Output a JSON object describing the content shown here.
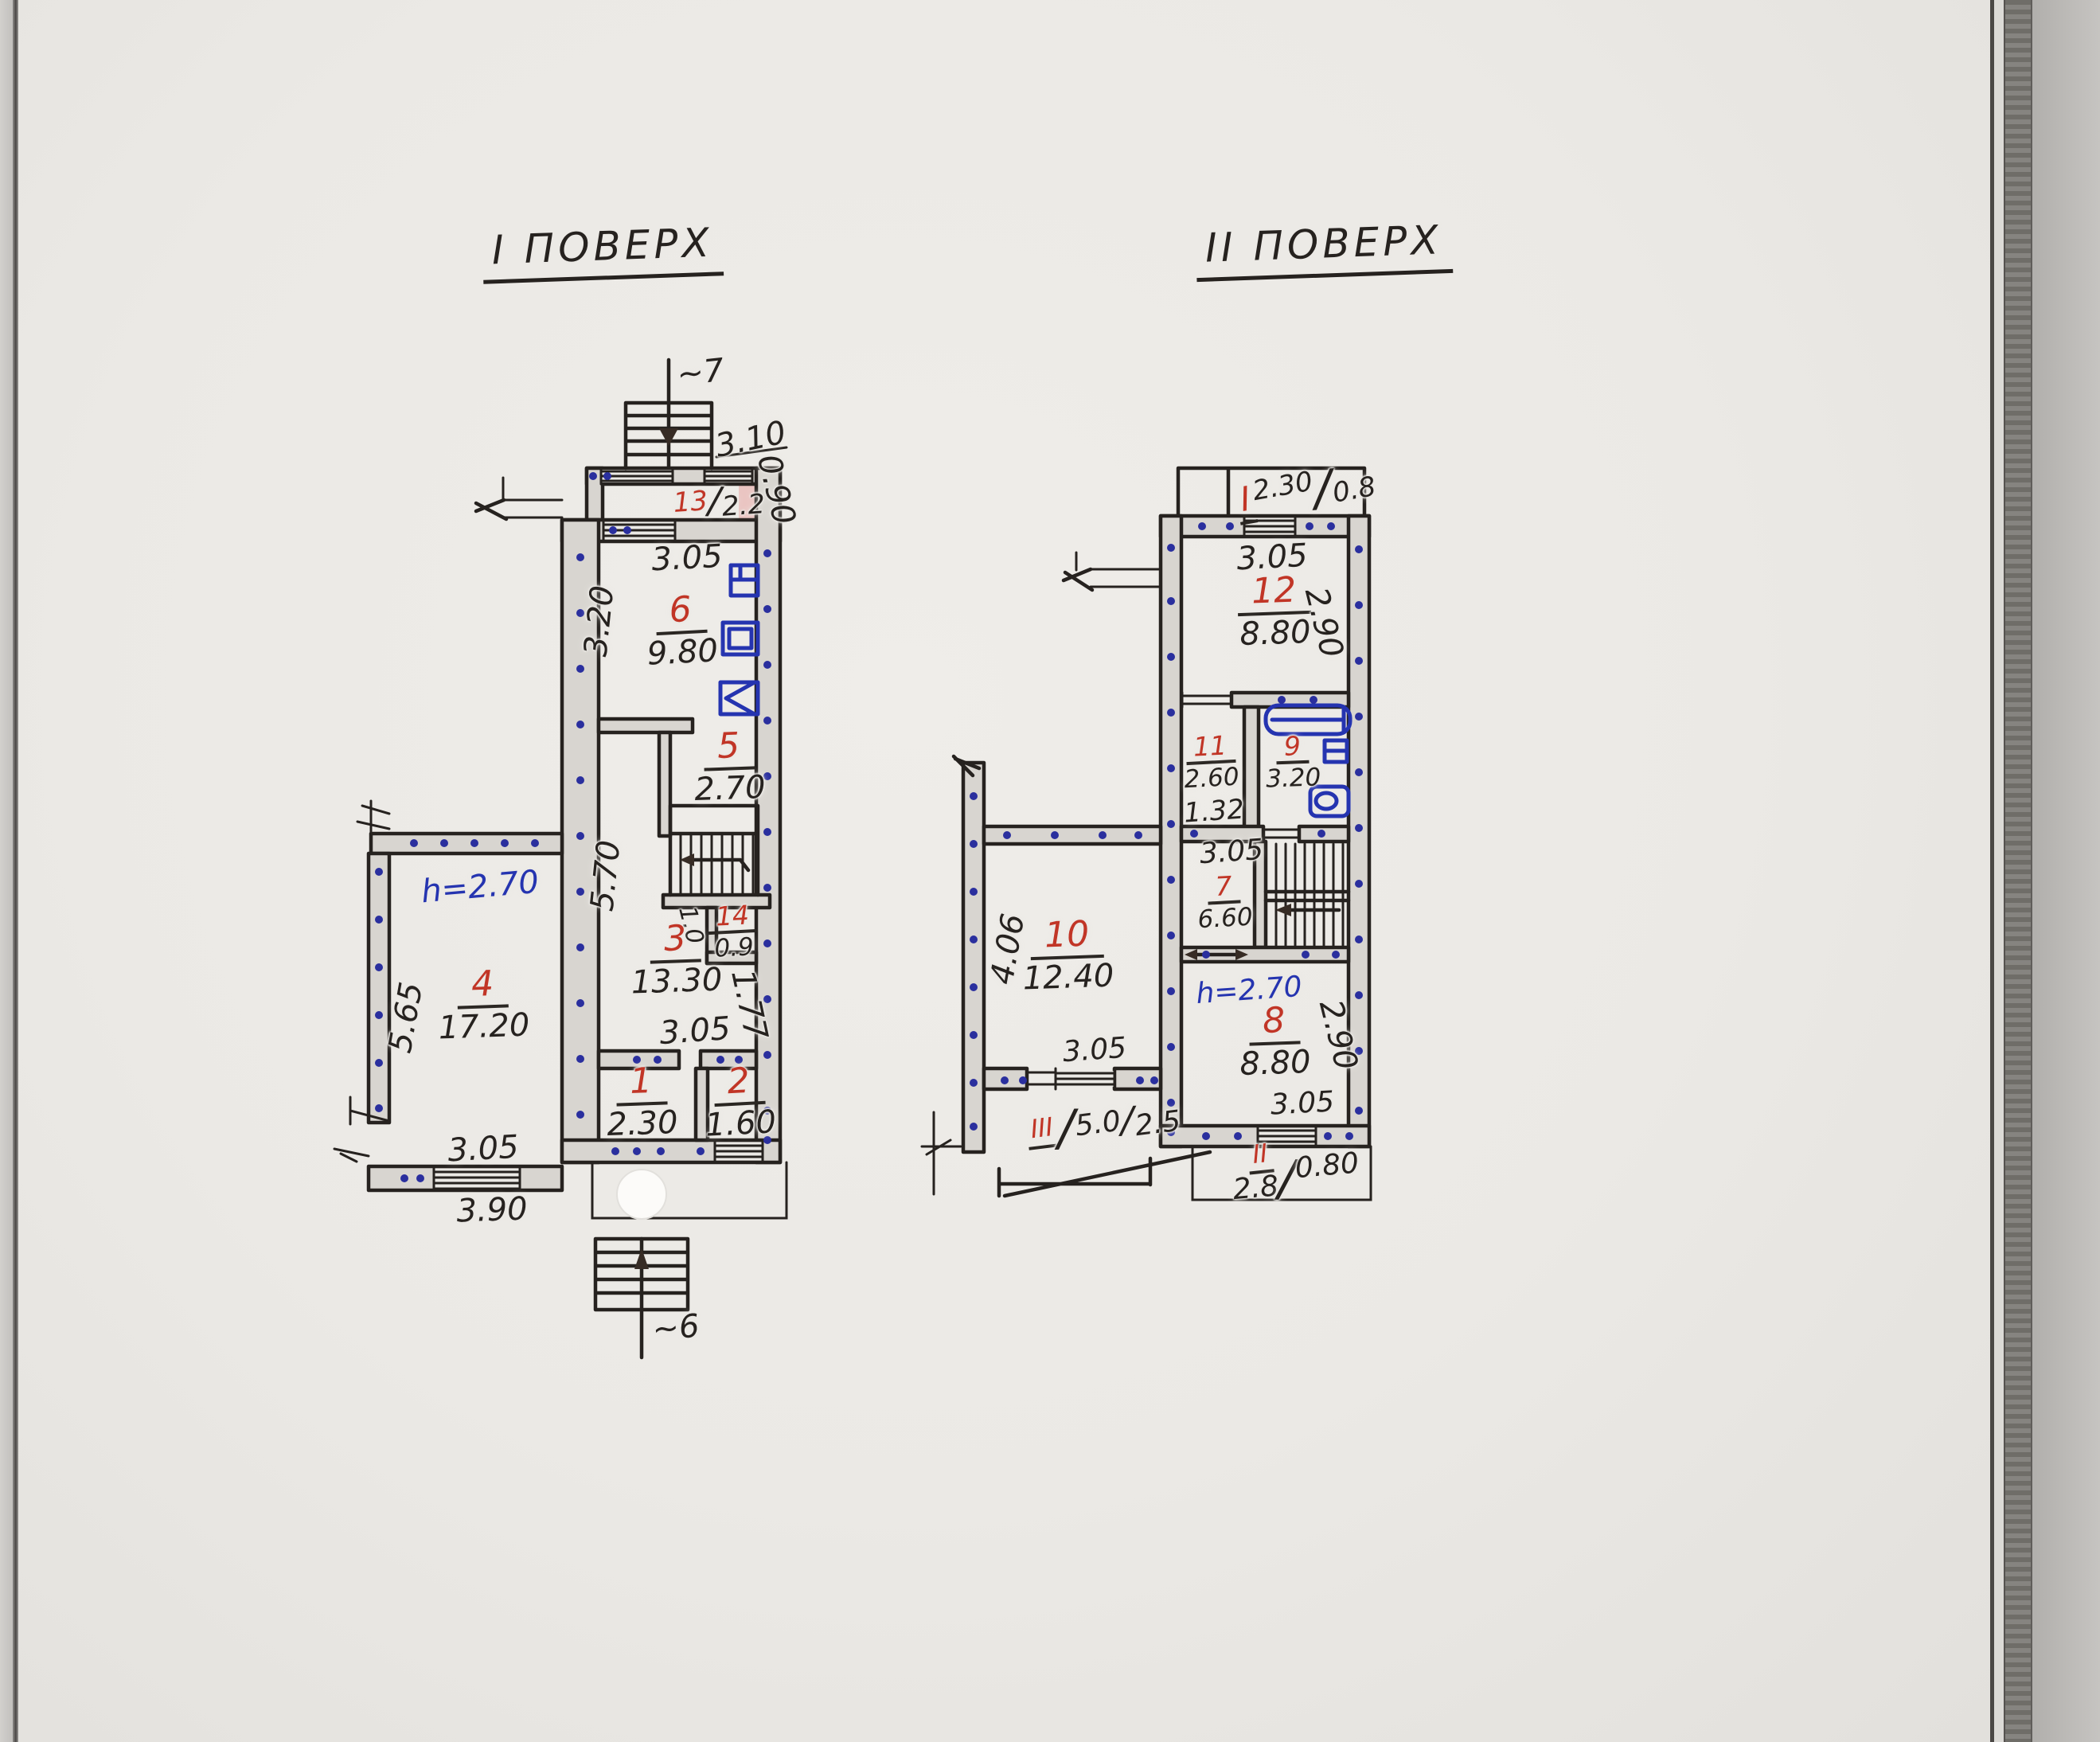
{
  "notation": {
    "slash": "/"
  },
  "floor1": {
    "title": "I ПОВЕРХ",
    "stairs_up": "~7",
    "stairs_down": "~6",
    "height_note": "h=2.70",
    "rooms": {
      "r1": {
        "num": "1",
        "area": "2.30"
      },
      "r2": {
        "num": "2",
        "area": "1.60"
      },
      "r3": {
        "num": "3",
        "area": "13.30"
      },
      "r4": {
        "num": "4",
        "area": "17.20"
      },
      "r5": {
        "num": "5",
        "area": "2.70"
      },
      "r6": {
        "num": "6",
        "area": "9.80"
      },
      "r13": {
        "num": "13",
        "area": "2.2"
      },
      "r14": {
        "num": "14",
        "area": "0.9"
      }
    },
    "dims": {
      "annex_width": "3.10",
      "annex_depth": "0.90",
      "room6_width": "3.05",
      "room6_depth": "3.20",
      "hall_depth": "5.70",
      "door_width": "1.0",
      "room3_width": "3.05",
      "room3_depth": "1.77",
      "room4_width": "3.05",
      "room4_depth": "5.65",
      "porch_width": "3.90"
    }
  },
  "floor2": {
    "title": "II ПОВЕРХ",
    "height_note": "h=2.70",
    "rooms": {
      "r7": {
        "num": "7",
        "area": "6.60"
      },
      "r8": {
        "num": "8",
        "area": "8.80"
      },
      "r9": {
        "num": "9",
        "area": "3.20"
      },
      "r10": {
        "num": "10",
        "area": "12.40"
      },
      "r11": {
        "num": "11",
        "area": "2.60"
      },
      "r12": {
        "num": "12",
        "area": "8.80"
      }
    },
    "dims": {
      "room12_width": "3.05",
      "room12_depth": "2.90",
      "room11_width": "1.32",
      "hall_width": "3.05",
      "room8_width": "3.05",
      "room8_depth": "2.90",
      "room10_width": "3.05",
      "room10_depth": "4.06"
    },
    "balcony_top": {
      "num": "I",
      "width": "2.30",
      "depth": "0.8"
    },
    "balcony_bottom": {
      "num": "II",
      "width": "2.8",
      "depth": "0.80"
    },
    "terrace": {
      "num": "III",
      "width": "5.0",
      "depth": "2.5"
    }
  }
}
